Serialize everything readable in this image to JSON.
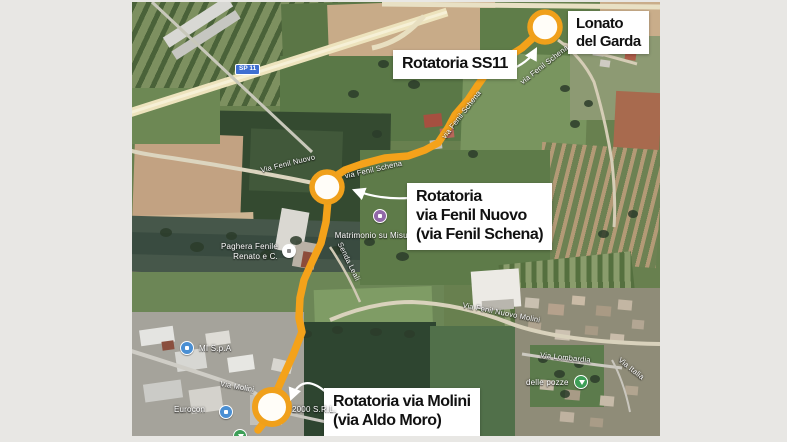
{
  "background_color": "#e8e7e4",
  "map": {
    "description": "satellite map of Lonato del Garda area with highlighted route",
    "road_shield": "SP 11",
    "road_labels": [
      {
        "text": "Via Fenil Nuovo"
      },
      {
        "text": "via Fenil Schena"
      },
      {
        "text": "via Fenil Schena"
      },
      {
        "text": "via Fenil Schena"
      },
      {
        "text": "Senda Leali"
      },
      {
        "text": "Via Molini"
      },
      {
        "text": "Via Fenil Nuovo Molini"
      },
      {
        "text": "Via Lombardia"
      },
      {
        "text": "Via Italia"
      }
    ],
    "pois": [
      {
        "label": "Matrimonio su Misura",
        "icon_color": "#9168A8"
      },
      {
        "label_line1": "Paghera Fenile",
        "label_line2": "Renato e C.",
        "icon_color": "#FFFFFF"
      },
      {
        "label": "MI S.p.A",
        "icon_color": "#4A8FD3"
      },
      {
        "label": "Eurocon",
        "icon_color": "#4A8FD3"
      },
      {
        "label": "delle pozze",
        "icon_color": "#3D9E57"
      },
      {
        "label": "2000 S.R.L."
      }
    ]
  },
  "route": {
    "color": "#F4A21A",
    "marker_ring_color": "#F0A01B",
    "marker_fill": "#FFFDF8",
    "markers": [
      "Lonato del Garda roundabout",
      "Fenil Nuovo roundabout",
      "Molini roundabout"
    ]
  },
  "callouts": {
    "lonato": {
      "line1": "Lonato",
      "line2": "del Garda"
    },
    "ss11": {
      "label": "Rotatoria SS11"
    },
    "fenil_nuovo": {
      "line1": "Rotatoria",
      "line2": "via Fenil Nuovo",
      "line3": "(via Fenil Schena)"
    },
    "molini": {
      "line1": "Rotatoria via Molini",
      "line2": "(via Aldo Moro)"
    }
  }
}
